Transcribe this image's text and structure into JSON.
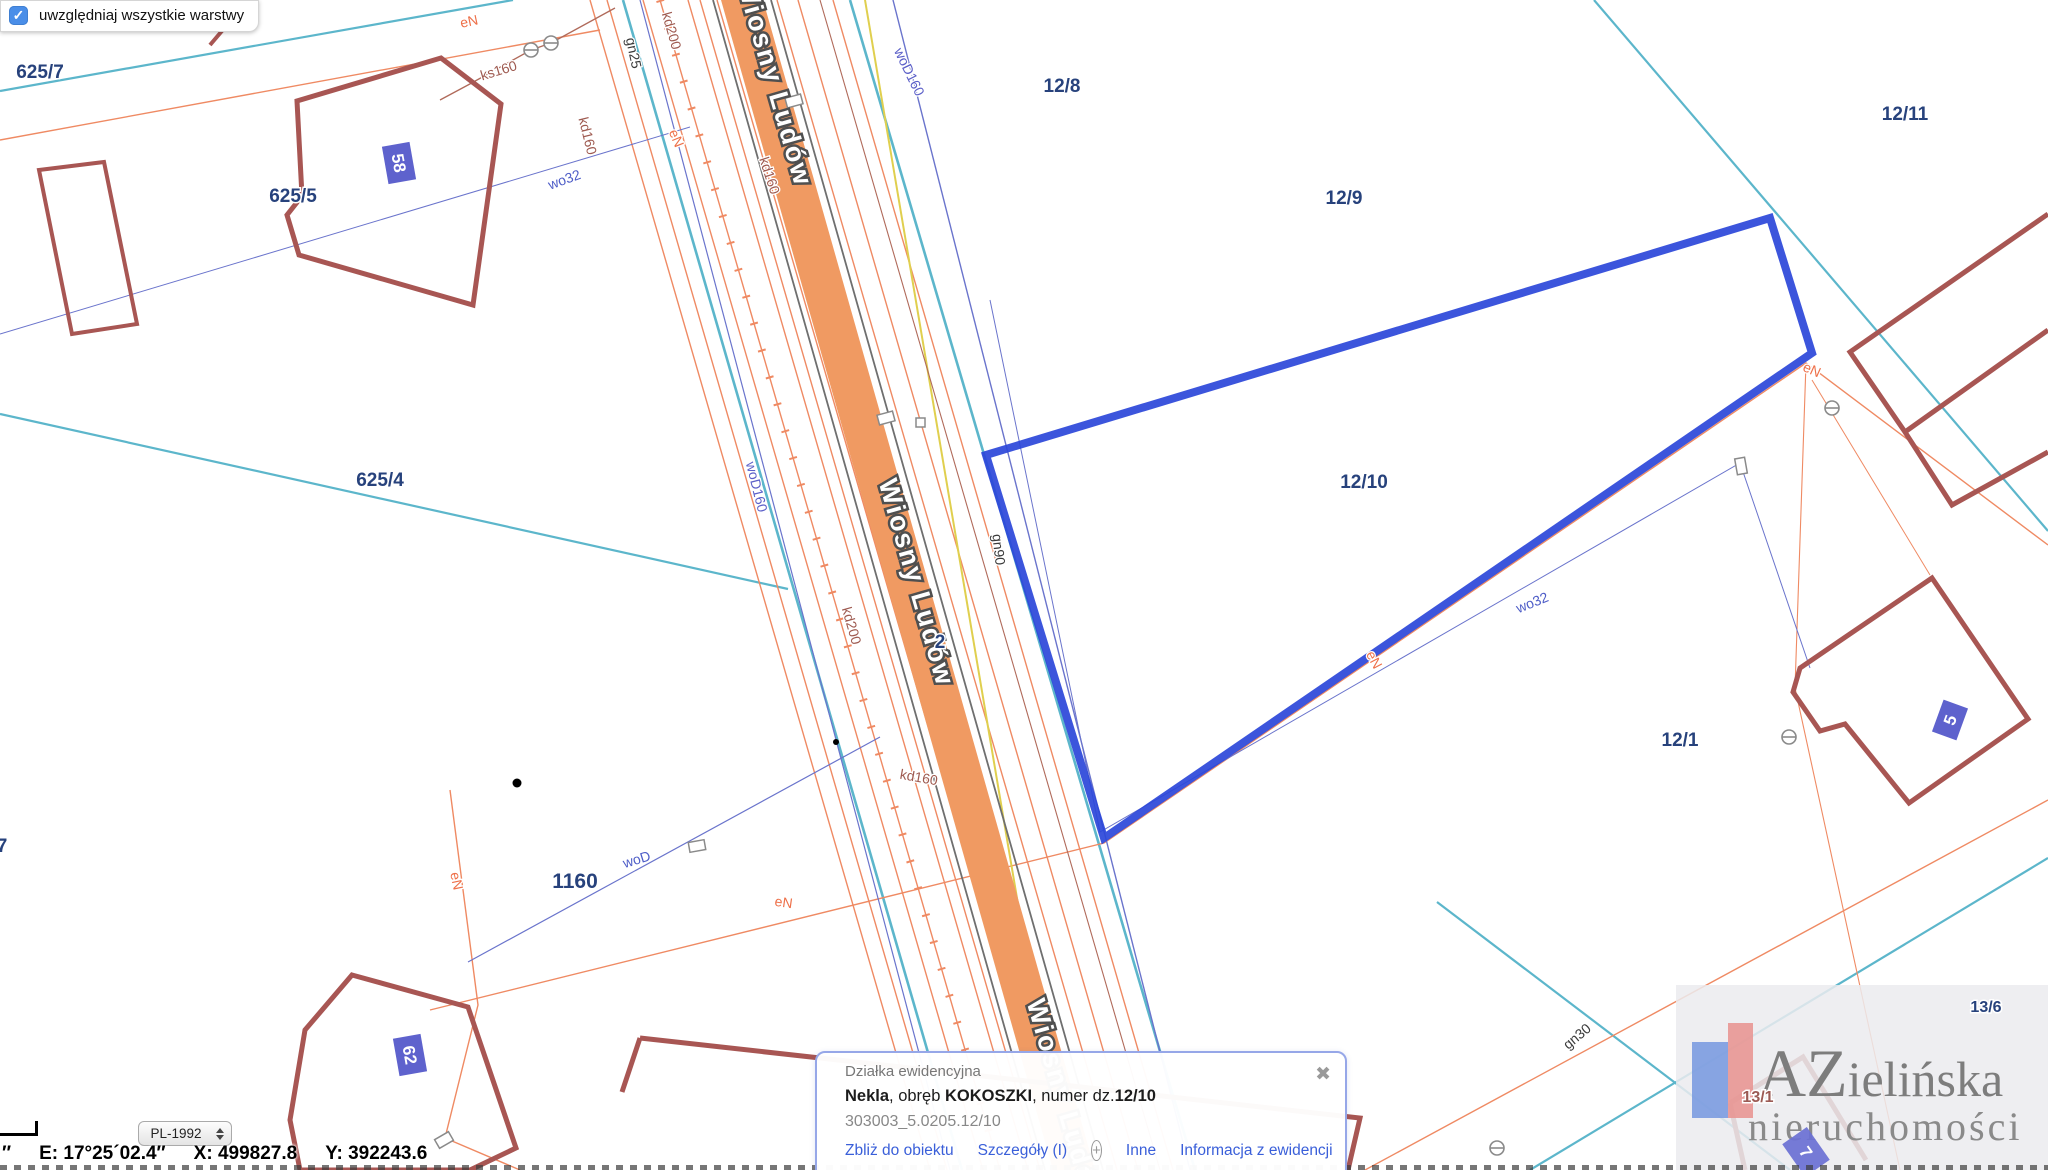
{
  "colors": {
    "highlight": "#2b46d9",
    "road_fill": "#f09a62",
    "boundary_teal": "#5cb6cb",
    "utility_orange": "#ee7049",
    "utility_blue": "#4d5cc7",
    "utility_brick": "#9e5a50",
    "parcel_label": "#27427c",
    "building_outline": "#a85653",
    "badge_blue": "#5055c9",
    "link_blue": "#3a5fd9"
  },
  "chrome": {
    "layers_toggle": {
      "label": "uwzględniaj wszystkie warstwy",
      "checked": true,
      "check_glyph": "✓"
    },
    "crs_select": {
      "value": "PL-1992"
    },
    "coords": {
      "lead": "″",
      "e": "E: 17°25´02.4″",
      "x": "X: 499827.8",
      "y": "Y: 392243.6"
    }
  },
  "popup": {
    "title": "Działka ewidencyjna",
    "line": {
      "b1": "Nekla",
      "s1": ", obręb ",
      "b2": "KOKOSZKI",
      "s2": ", numer dz.",
      "b3": "12/10"
    },
    "id": "303003_5.0205.12/10",
    "links": {
      "zoom_to": "Zbliż do obiektu",
      "details": "Szczegóły (I)",
      "other": "Inne",
      "info": "Informacja z ewidencji"
    },
    "close_glyph": "✖",
    "plus_glyph": "+"
  },
  "logo": {
    "brand_a": "AZ",
    "brand_b": "ielińska",
    "sub": "nieruchomości"
  },
  "map": {
    "street_labels": [
      "Wiosny Ludów",
      "Wiosny Ludów",
      "Wiosny Ludów"
    ],
    "parcel_labels": [
      "625/7",
      "625/5",
      "625/4",
      "1160",
      "12/8",
      "12/9",
      "12/10",
      "12/11",
      "12/1",
      "13/6",
      "13/1",
      "2",
      "7"
    ],
    "building_badges": [
      "58",
      "62",
      "5",
      "7"
    ],
    "utility_labels": [
      "eN",
      "eN",
      "eN",
      "eN",
      "eN",
      "eN",
      "ks160",
      "kd200",
      "kd160",
      "kd160",
      "kd200",
      "kd160",
      "gn25",
      "gn90",
      "gn30",
      "wo32",
      "wo32",
      "woD160",
      "woD160",
      "woD"
    ]
  }
}
